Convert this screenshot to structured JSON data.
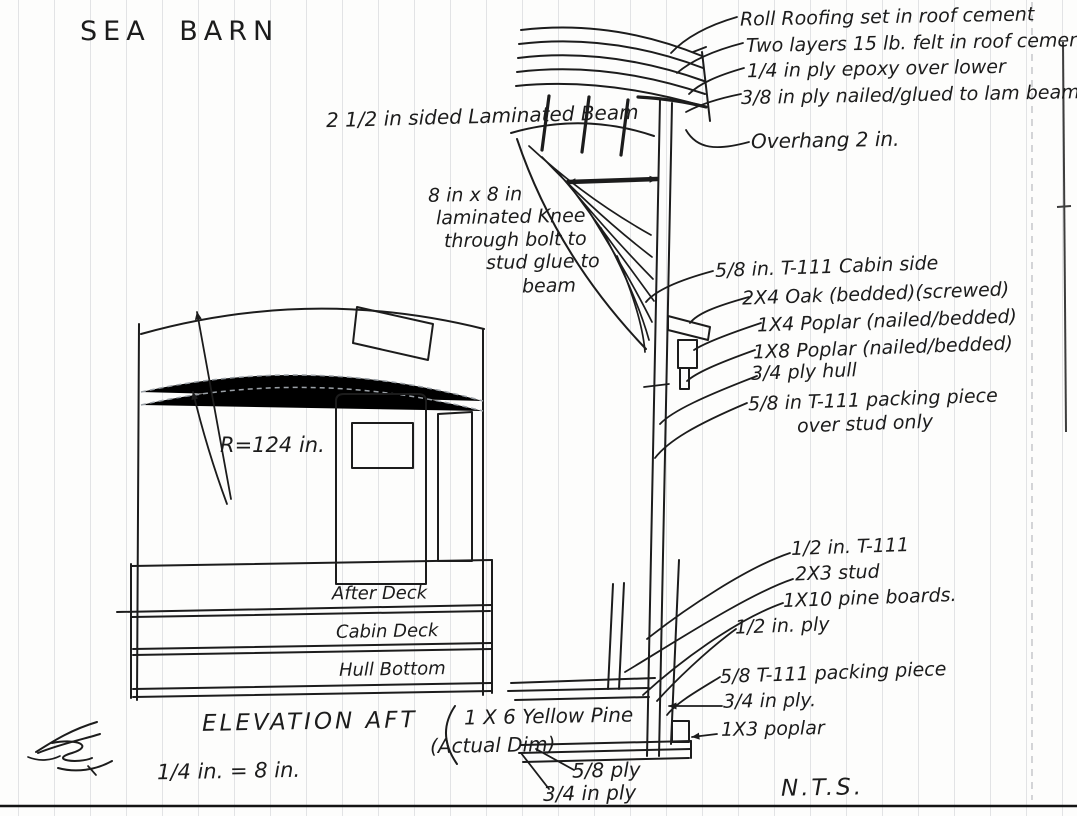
{
  "page": {
    "title": "SEA BARN",
    "drawing_title": "ELEVATION AFT",
    "scale_note": "1/4 in. = 8 in.",
    "nts_note": "N.T.S."
  },
  "ink_color": "#1c1c1c",
  "elevation": {
    "radius_label": "R=124 in.",
    "deck_labels": [
      "After Deck",
      "Cabin Deck",
      "Hull Bottom"
    ]
  },
  "roof_detail": {
    "beam_label": "2 1/2 in sided  Laminated Beam",
    "knee_note_lines": [
      "8 in x 8 in",
      "laminated Knee",
      "through bolt to",
      "stud glue to",
      "beam"
    ],
    "callouts": [
      "Roll Roofing set in roof cement",
      "Two layers 15 lb. felt in roof cement",
      "1/4 in ply epoxy over lower",
      "3/8 in ply nailed/glued to lam beams",
      "Overhang 2 in."
    ]
  },
  "cabin_side_detail": {
    "callouts": [
      "5/8 in. T-111 Cabin side",
      "2X4  Oak  (bedded)(screwed)",
      "1X4  Poplar  (nailed/bedded)",
      "1X8  Poplar  (nailed/bedded)",
      "3/4 ply hull",
      "5/8 in T-111 packing piece",
      "over stud only"
    ]
  },
  "deck_joint_detail": {
    "callouts": [
      "1/2 in. T-111",
      "2X3 stud",
      "1X10 pine boards.",
      "1/2 in. ply",
      "5/8 T-111 packing piece",
      "3/4 in ply.",
      "1X3 poplar"
    ],
    "pine_label_lines": [
      "1 X 6 Yellow Pine",
      "(Actual Dim)"
    ],
    "ply_labels": [
      "5/8 ply",
      "3/4 in ply"
    ]
  }
}
